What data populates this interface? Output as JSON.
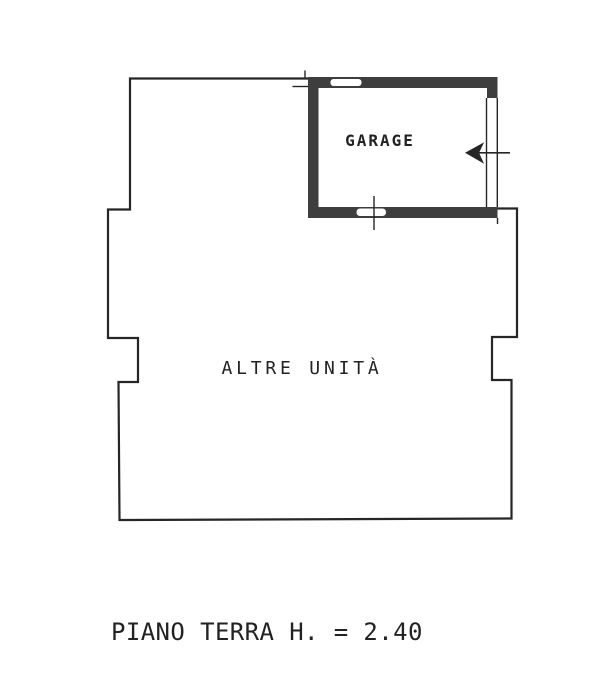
{
  "colors": {
    "paper": "#ffffff",
    "ink": "#262626",
    "wall": "#3e3e3e",
    "text": "#222222"
  },
  "floorplan": {
    "garage_label": "GARAGE",
    "other_units_label": "ALTRE UNITÀ",
    "caption": "PIANO TERRA H. = 2.40",
    "icons": {
      "entrance_arrow": "left-arrow"
    }
  }
}
